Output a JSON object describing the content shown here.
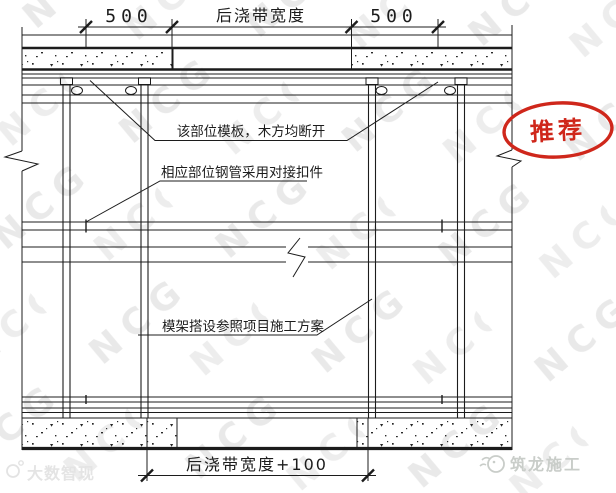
{
  "watermark": {
    "pattern_text": "NCG"
  },
  "dimensions": {
    "top_left": "500",
    "top_center": "后浇带宽度",
    "top_right": "500",
    "bottom": "后浇带宽度+100"
  },
  "annotations": {
    "formwork": "该部位模板，木方均断开",
    "coupler": "相应部位钢管采用对接扣件",
    "scheme": "模架搭设参照项目施工方案"
  },
  "stamp": {
    "label": "推荐",
    "color": "#cf271b"
  },
  "footer": {
    "left_logo": "大数智现",
    "right_logo": "筑龙施工"
  },
  "colors": {
    "line": "#1c1c1c",
    "stamp": "#cf271b",
    "watermark_gray": "#e9e9e9",
    "logo_gray": "#c9cdc9"
  }
}
